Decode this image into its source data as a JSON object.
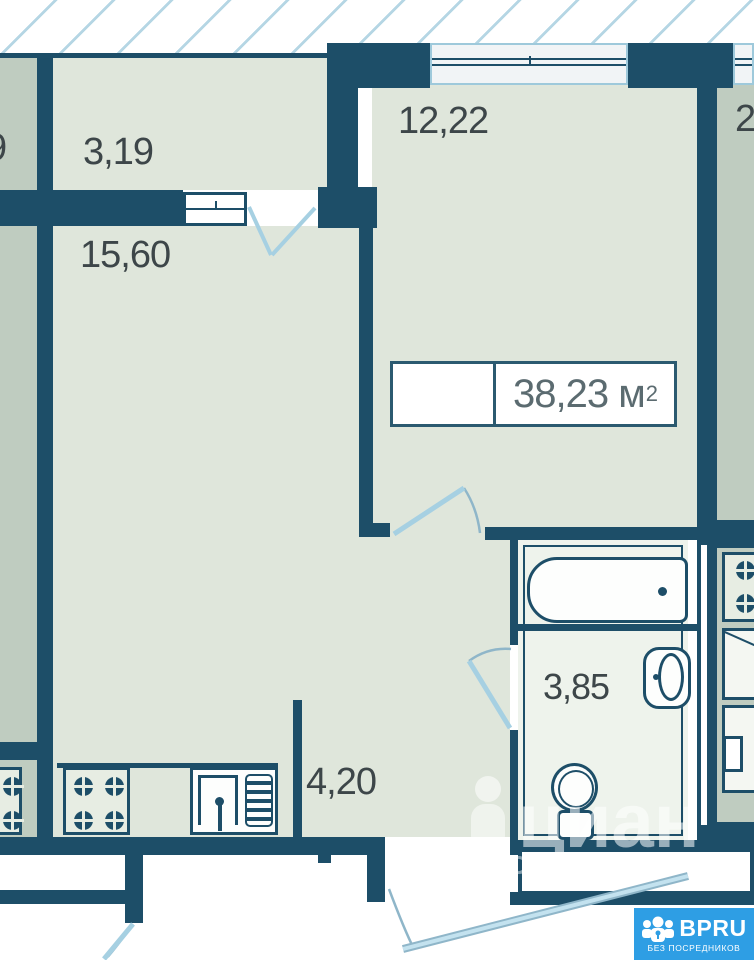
{
  "floorplan": {
    "title": "1-room apartment floor plan",
    "rooms": [
      {
        "id": "hall-top",
        "label": "3,19"
      },
      {
        "id": "kitchen-living",
        "label": "15,60"
      },
      {
        "id": "bedroom",
        "label": "12,22"
      },
      {
        "id": "corridor",
        "label": "4,20"
      },
      {
        "id": "bathroom",
        "label": "3,85"
      }
    ],
    "total_area": {
      "value": "38,23",
      "unit": "м",
      "sup": "2"
    },
    "neighbors": {
      "left_partial": "9",
      "right_partial": "2"
    },
    "watermark": {
      "text": "циан",
      "letter": "D"
    },
    "logo": {
      "name": "BPRU",
      "tagline": "БЕЗ ПОСРЕДНИКОВ"
    },
    "icons": [
      "bathtub-icon",
      "toilet-icon",
      "washbasin-icon",
      "stove-icon",
      "kitchen-sink-icon",
      "neighbor-stove-icon",
      "window-icon",
      "door-swing-icon",
      "person-pin-icon",
      "bpru-people-icon"
    ],
    "colors": {
      "wall": "#1d4e68",
      "room_floor": "#dfe6db",
      "neighbor_floor": "#bfccc0",
      "bathroom_floor": "#eef3ec",
      "door_swing": "#a6d0e2",
      "hatch_line": "#b5d6e4",
      "label_text": "#3d4649",
      "area_text": "#5b6b70",
      "logo_blue": "#2e9ee4"
    }
  }
}
